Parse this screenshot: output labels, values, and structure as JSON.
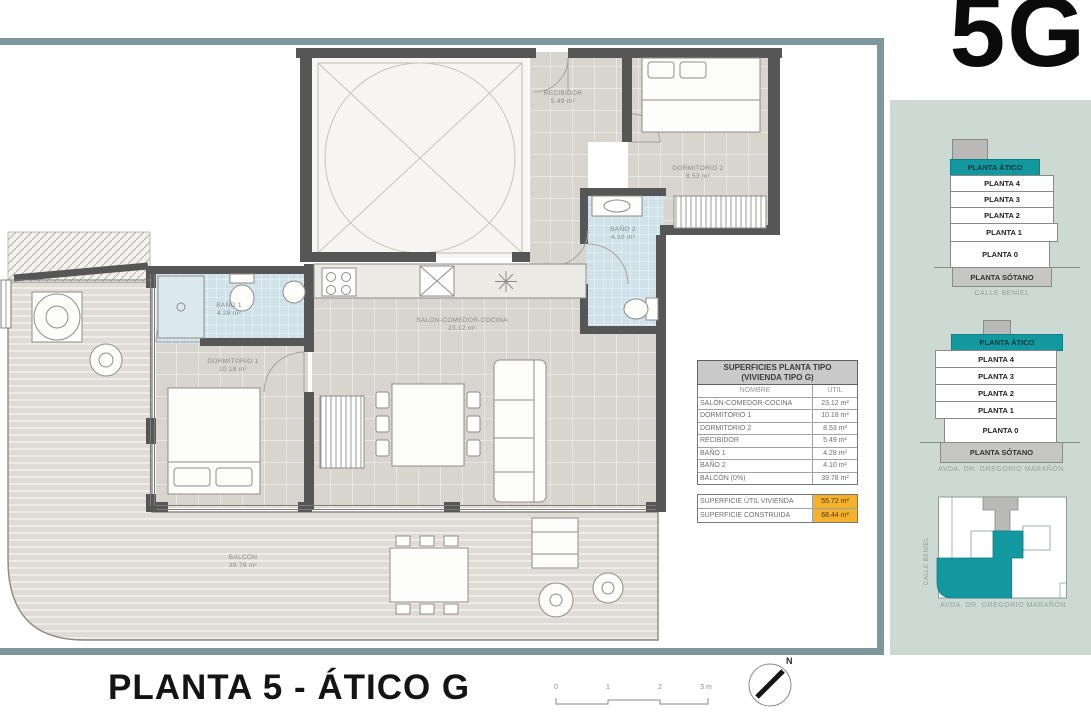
{
  "logo": "5G",
  "plan": {
    "title": "PLANTA 5 - ÁTICO G",
    "rooms": {
      "recibidor": {
        "name": "RECIBIDOR",
        "area": "5.49 m²"
      },
      "dormitorio2": {
        "name": "DORMITORIO 2",
        "area": "8.53 m²"
      },
      "bano2": {
        "name": "BAÑO 2",
        "area": "4.10 m²"
      },
      "salon": {
        "name": "SALON-COMEDOR-COCINA",
        "area": "23.12 m²"
      },
      "bano1": {
        "name": "BAÑO 1",
        "area": "4.28 m²"
      },
      "dormitorio1": {
        "name": "DORMITORIO 1",
        "area": "10.18 m²"
      },
      "balcon": {
        "name": "BALCÓN",
        "area": "39.78 m²"
      }
    },
    "scalebar": {
      "ticks": [
        "0",
        "1",
        "2",
        "3 m"
      ]
    },
    "north_label": "N"
  },
  "table": {
    "title_line1": "SUPERFICIES PLANTA TIPO",
    "title_line2": "(VIVIENDA TIPO G)",
    "col_name": "NOMBRE",
    "col_util": "ÚTIL",
    "rows": [
      {
        "name": "SALÓN-COMEDOR-COCINA",
        "util": "23.12 m²"
      },
      {
        "name": "DORMITORIO 1",
        "util": "10.18 m²"
      },
      {
        "name": "DORMITORIO 2",
        "util": "8.53 m²"
      },
      {
        "name": "RECIBIDOR",
        "util": "5.49 m²"
      },
      {
        "name": "BAÑO 1",
        "util": "4.28 m²"
      },
      {
        "name": "BAÑO 2",
        "util": "4.10 m²"
      },
      {
        "name": "BALCÓN (0%)",
        "util": "39.78 m²"
      }
    ],
    "totals": [
      {
        "name": "SUPERFICIE ÚTIL VIVIENDA",
        "util": "55.72 m²"
      },
      {
        "name": "SUPERFICIE CONSTRUIDA",
        "util": "68.44 m²"
      }
    ]
  },
  "sidebar": {
    "stack1": {
      "levels": [
        "PLANTA ÁTICO",
        "PLANTA 4",
        "PLANTA 3",
        "PLANTA 2",
        "PLANTA 1",
        "PLANTA 0",
        "PLANTA SÓTANO"
      ],
      "caption": "CALLE BENIEL"
    },
    "stack2": {
      "levels": [
        "PLANTA ÁTICO",
        "PLANTA 4",
        "PLANTA 3",
        "PLANTA 2",
        "PLANTA 1",
        "PLANTA 0",
        "PLANTA SÓTANO"
      ],
      "caption": "AVDA. DR. GREGORIO MARAÑÓN"
    },
    "siteplan": {
      "street_left": "CALLE BENIEL",
      "caption": "AVDA. DR. GREGORIO MARAÑÓN"
    }
  },
  "colors": {
    "teal": "#12999f",
    "frame": "#7d989d",
    "sidebar_bg": "#cdd9d3",
    "highlight": "#f3b12e",
    "wall": "#565656"
  }
}
